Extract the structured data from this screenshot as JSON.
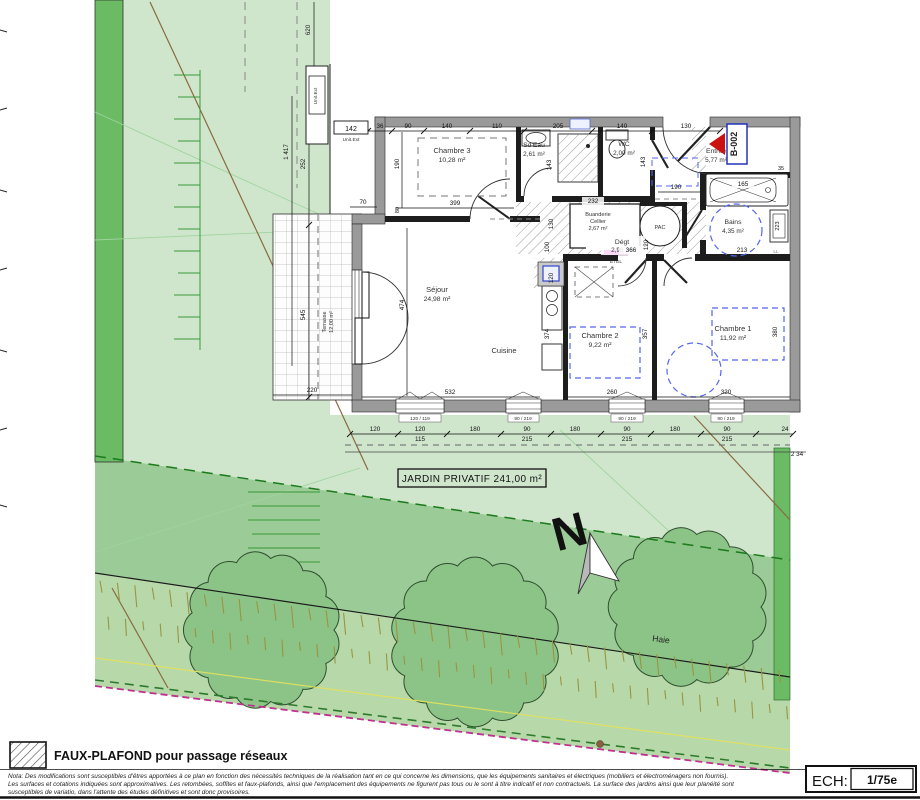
{
  "unit": {
    "ref": "B-002",
    "ext_unit": "Unit.Ext"
  },
  "rooms": {
    "chambre3": {
      "name": "Chambre 3",
      "area": "10,28 m²"
    },
    "sdeau": {
      "name": "Sd'Eau",
      "area": "2,61 m²"
    },
    "wc": {
      "name": "WC",
      "area": "2,00 m²"
    },
    "entree": {
      "name": "Entrée",
      "area": "5,77 m²"
    },
    "buanderie": {
      "name": "Buanderie",
      "name2": "Cellier",
      "area": "2,67 m²"
    },
    "bains": {
      "name": "Bains",
      "area": "4,35 m²"
    },
    "degt": {
      "name": "Dégt",
      "area": "2,98 m²"
    },
    "sejour": {
      "name": "Séjour",
      "area": "24,98 m²"
    },
    "cuisine": {
      "name": "Cuisine"
    },
    "chambre2": {
      "name": "Chambre 2",
      "area": "9,22 m²"
    },
    "chambre1": {
      "name": "Chambre 1",
      "area": "11,92 m²"
    },
    "terrasse": {
      "name": "Terrasse",
      "area": "12,00 m²"
    }
  },
  "equipment": {
    "pac": "PAC",
    "etel": "ETEL",
    "ll": "LL"
  },
  "garden": {
    "label": "JARDIN PRIVATIF 241,00 m²",
    "haie": "Haie",
    "north": "N"
  },
  "dims": {
    "top_boxed": "142",
    "top": [
      "36",
      "90",
      "140",
      "110",
      "205",
      "140",
      "130"
    ],
    "left": {
      "d620": "620",
      "d1417": "1 417",
      "d252": "252",
      "d545": "545",
      "d220": "220",
      "d70": "70"
    },
    "inner": {
      "c3w": "399",
      "c3h": "190",
      "c3b": "80",
      "sdeh": "143",
      "wch": "143",
      "b232": "232",
      "b130": "130",
      "k100": "100",
      "k120": "120",
      "k120b": "120",
      "e190": "190",
      "t165": "165",
      "t35": "35",
      "cab223": "223",
      "sej474": "474",
      "cui374": "374",
      "c2t": "366",
      "c1t": "213",
      "c2h": "357",
      "c1h": "380",
      "sej532": "532",
      "c2w": "260",
      "c1w": "320"
    },
    "bottom": [
      "120",
      "120",
      "115",
      "180",
      "90",
      "215",
      "180",
      "90",
      "215",
      "180",
      "90",
      "215",
      "24"
    ],
    "right_edge": "2 34"
  },
  "windows": [
    "120 / 119",
    "90 / 219",
    "90 / 219",
    "90 / 219"
  ],
  "legend": {
    "faux_plafond": "FAUX-PLAFOND pour passage réseaux",
    "nota1": "Nota: Des modifications sont susceptibles d'êtres apportées à ce plan en fonction des nécessités techniques de la réalisation tant en ce qui concerne les dimensions, que les équipements sanitaires et électriques (mobiliers et électroménagers non fournis).",
    "nota2": "Les surfaces et cotations indiquées sont approximatives. Les retombées, soffites et faux-plafonds, ainsi que l'emplacement des équipements ne figurent pas tous ou le sont à titre indicatif et non contractuels. La surface des jardins ainsi que leur planéité sont",
    "nota3": "susceptibles de variatio, dans l'attente des études définitives et sont donc provisoires."
  },
  "scale": {
    "label": "ECH:",
    "value": "1/75e"
  },
  "colors": {
    "garden_light": "#cfe6cc",
    "garden_dark": "#6abb64",
    "hedge_mid": "#9bcb96",
    "hedge_low": "#b7d9aa",
    "wall_gray": "#9a9a9a",
    "unit_blue": "#2233bb",
    "arrow_red": "#cc1111",
    "etel_magenta": "#ee00cc",
    "boundary_magenta": "#c03090"
  }
}
